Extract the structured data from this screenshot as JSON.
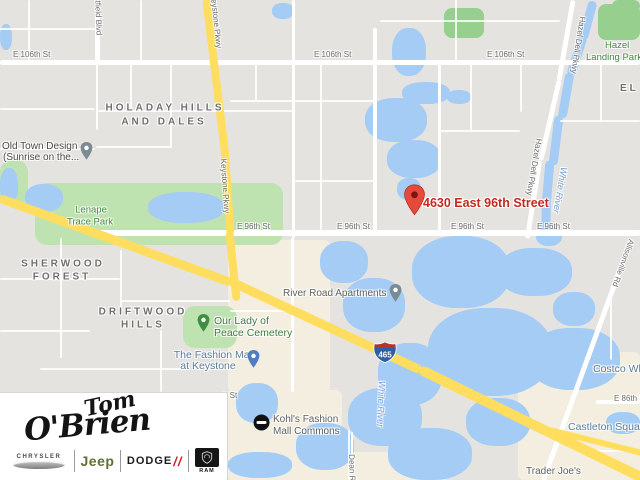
{
  "map": {
    "address_label": "4630 East 96th Street",
    "highway_shield": "465",
    "street_labels": [
      "E 106th St",
      "E 106th St",
      "E 106th St",
      "E 96th St",
      "E 96th St",
      "E 96th St",
      "E 96th St",
      "E 86th St",
      "h St",
      "Keystone Pkwy",
      "Keystone Pkwy",
      "Hazel Dell Pkwy",
      "Hazel Dell Pkwy",
      "Westfield Blvd",
      "Allisonville Rd",
      "Dean Rd"
    ],
    "river_labels": [
      "White River",
      "White River"
    ],
    "neighborhoods": [
      "HOLADAY HILLS",
      "AND DALES",
      "SHERWOOD",
      "FOREST",
      "DRIFTWOOD",
      "HILLS",
      "EL"
    ],
    "parks": [
      "Lenape",
      "Trace Park",
      "Hazel",
      "Landing Park",
      "Our Lady of",
      "Peace Cemetery"
    ],
    "pois": [
      "Old Town Design",
      "(Sunrise on the...",
      "River Road Apartments",
      "The Fashion Mall",
      "at Keystone",
      "Kohl's Fashion",
      "Mall Commons",
      "Castleton Square",
      "Trader Joe's",
      "Costco Wholesale"
    ]
  },
  "logo": {
    "dealer_name": "Tom O'Brien",
    "script_line1": "Tom",
    "script_line2": "O'Brien",
    "brands": {
      "chrysler": "CHRYSLER",
      "jeep": "Jeep",
      "dodge": "DODGE",
      "dodge_slashes": "//",
      "ram": "RAM"
    }
  },
  "colors": {
    "land": "#E5E3DF",
    "water": "#A4CCF5",
    "park": "#BFE3B0",
    "park_dark": "#96CF8E",
    "road": "#FFFFFF",
    "highway": "#FFDD5E",
    "commercial": "#F3EEDF",
    "address_red": "#C5281E",
    "pin_red": "#E64A3C"
  }
}
